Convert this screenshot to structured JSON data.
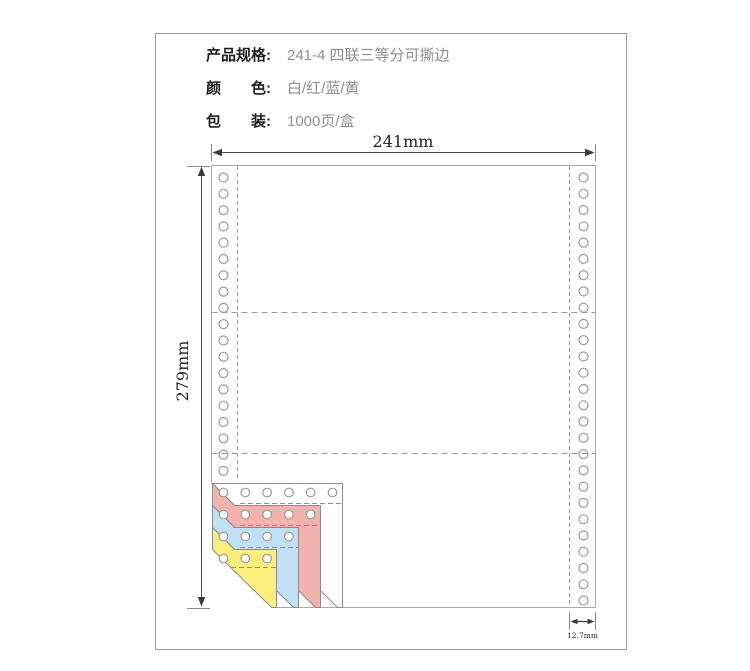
{
  "spec": {
    "rows": [
      {
        "label": "产品规格:",
        "value": "241-4 四联三等分可撕边"
      },
      {
        "label": "颜　　色:",
        "value": "白/红/蓝/黄"
      },
      {
        "label": "包　　装:",
        "value": "1000页/盒"
      }
    ]
  },
  "diagram": {
    "width_label": "241mm",
    "height_label": "279mm",
    "strip_label": "12.7mm",
    "plies": [
      {
        "name": "white-ply",
        "color": "#ffffff"
      },
      {
        "name": "red-ply",
        "color": "#f2b3ac"
      },
      {
        "name": "blue-ply",
        "color": "#bfe0f5"
      },
      {
        "name": "yellow-ply",
        "color": "#fbee7d"
      }
    ],
    "line_color": "#a0a0a0",
    "arrow_color": "#3a3a3a"
  }
}
